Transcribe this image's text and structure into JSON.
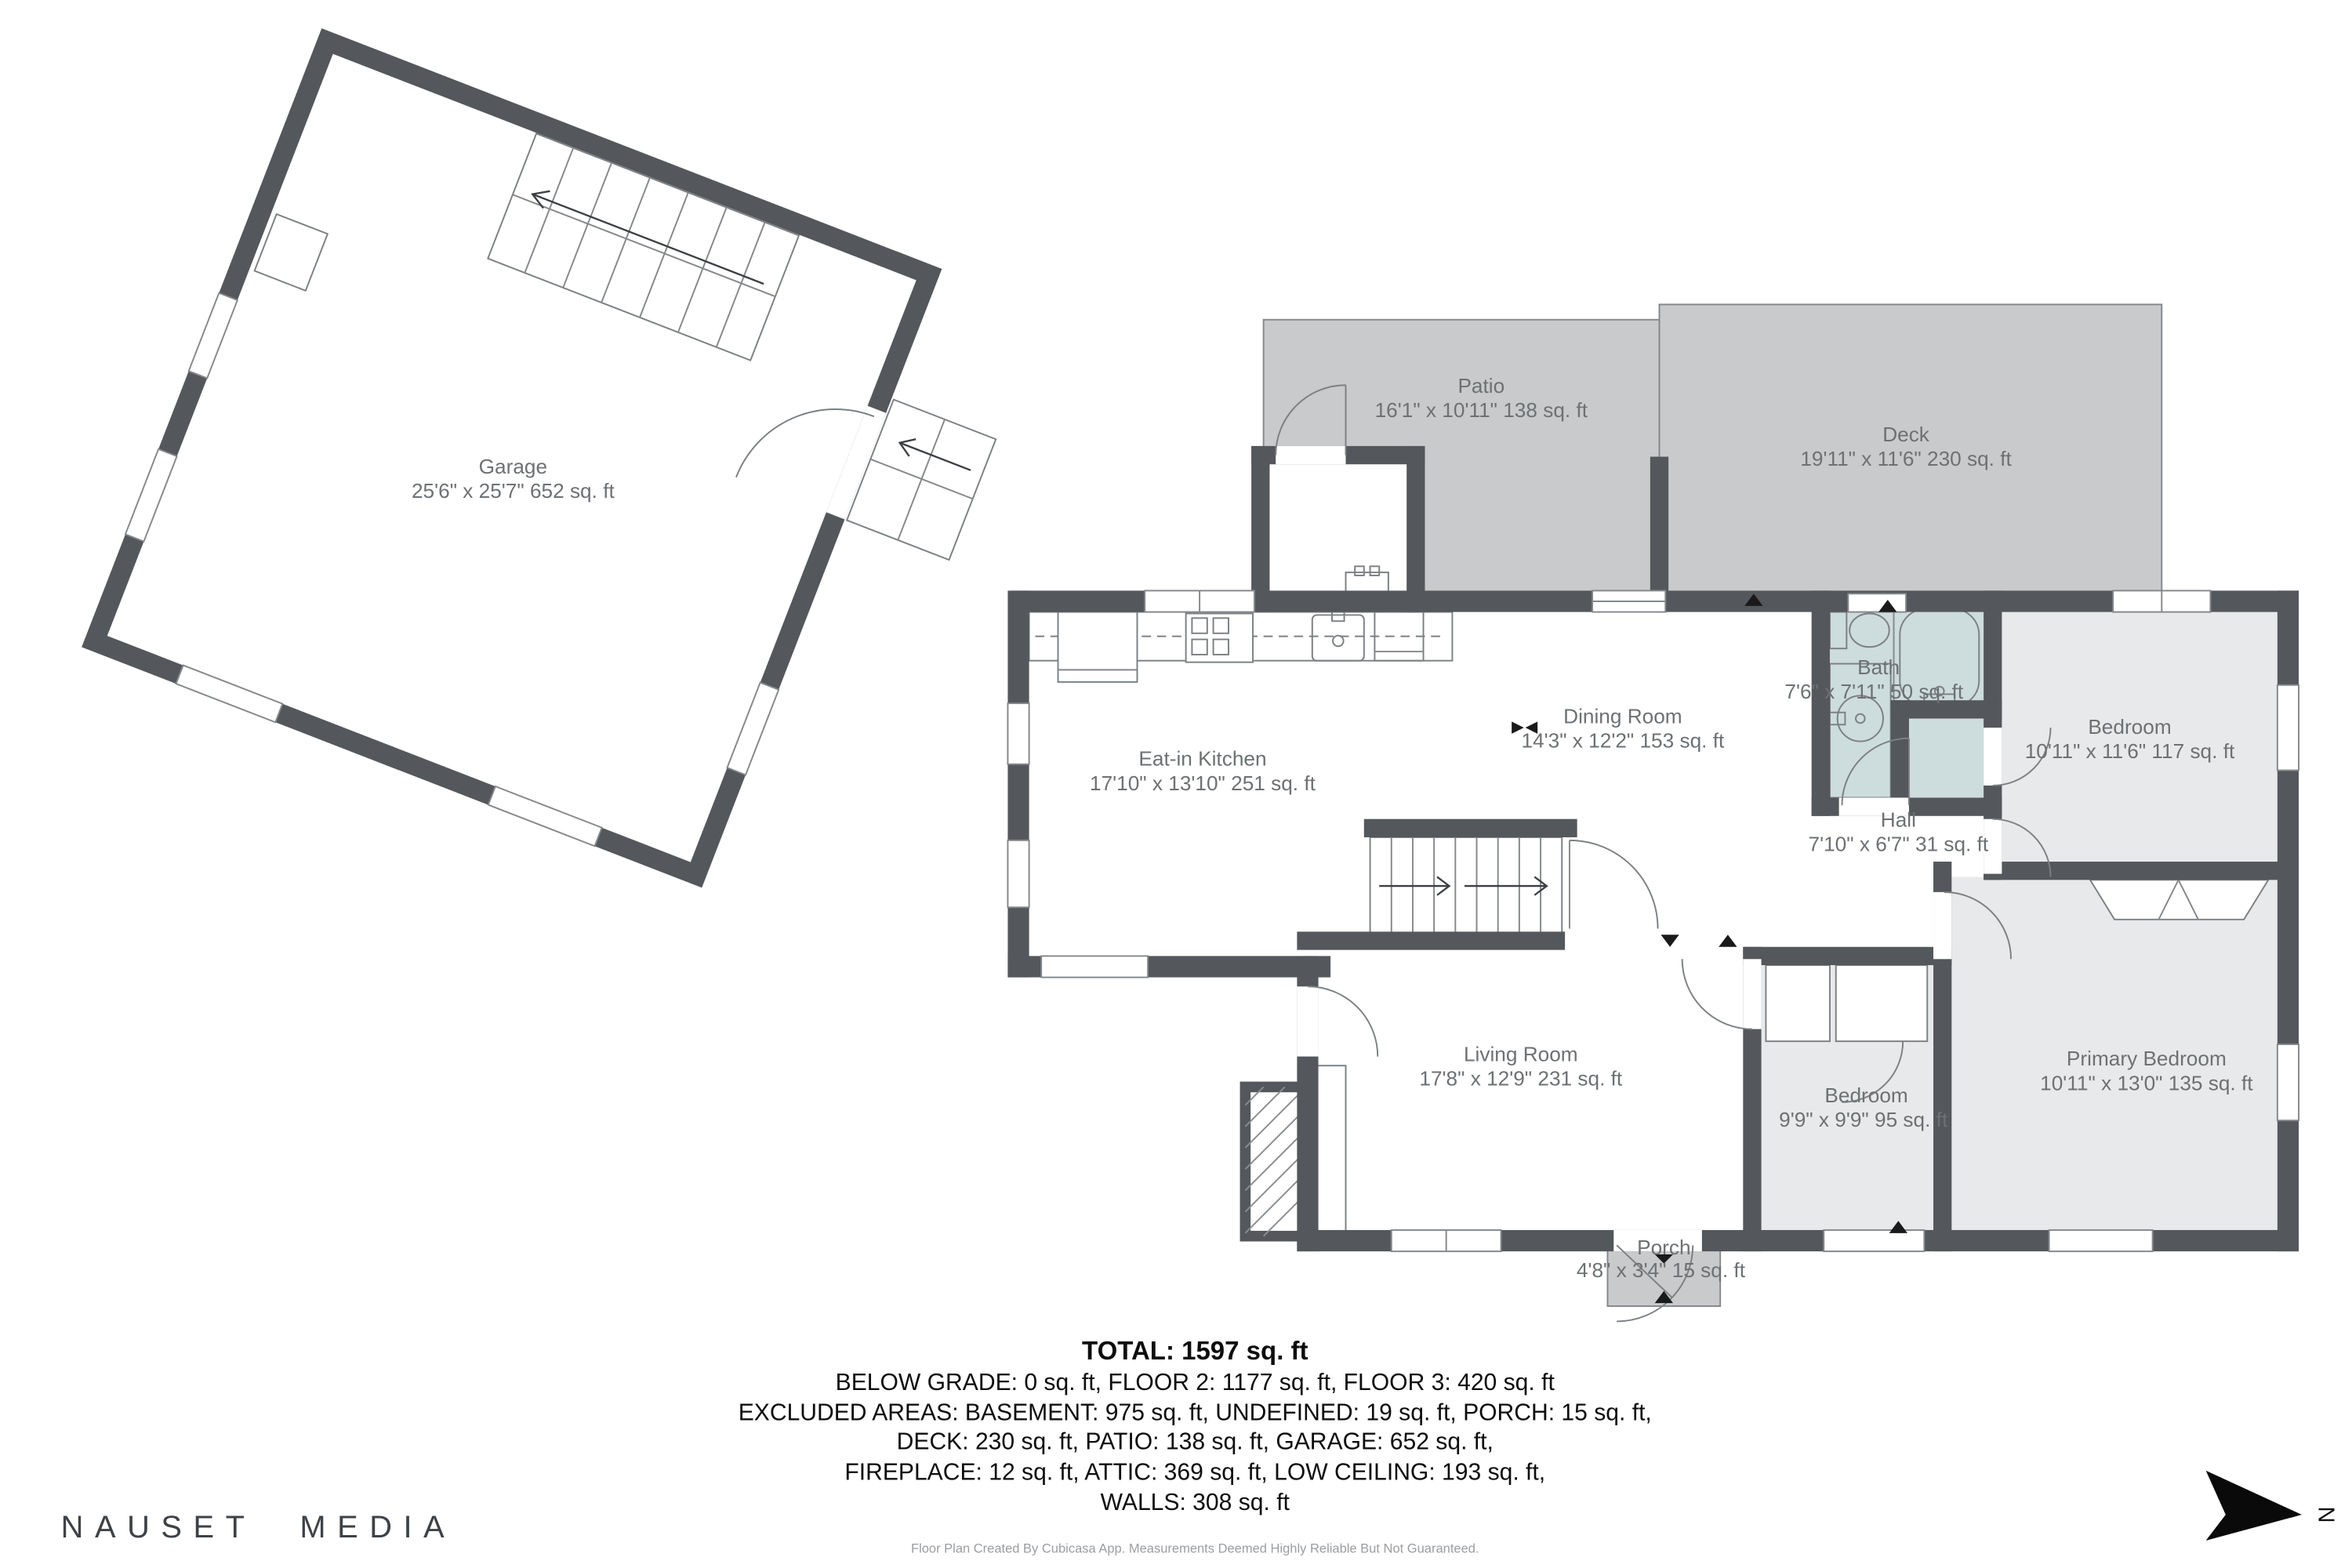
{
  "rooms": {
    "garage": {
      "name": "Garage",
      "dims": "25'6\" x 25'7\" 652 sq. ft"
    },
    "patio": {
      "name": "Patio",
      "dims": "16'1\" x 10'11\" 138 sq. ft"
    },
    "deck": {
      "name": "Deck",
      "dims": "19'11\" x 11'6\" 230 sq. ft"
    },
    "bath": {
      "name": "Bath",
      "dims": "7'6\" x 7'11\" 50 sq. ft"
    },
    "bedroom_top_right": {
      "name": "Bedroom",
      "dims": "10'11\" x 11'6\" 117 sq. ft"
    },
    "dining_room": {
      "name": "Dining Room",
      "dims": "14'3\" x 12'2\" 153 sq. ft"
    },
    "kitchen": {
      "name": "Eat-in Kitchen",
      "dims": "17'10\" x 13'10\" 251 sq. ft"
    },
    "hall": {
      "name": "Hall",
      "dims": "7'10\" x 6'7\" 31 sq. ft"
    },
    "living_room": {
      "name": "Living Room",
      "dims": "17'8\" x 12'9\" 231 sq. ft"
    },
    "bedroom_bottom": {
      "name": "Bedroom",
      "dims": "9'9\" x 9'9\" 95 sq. ft"
    },
    "primary_bedroom": {
      "name": "Primary Bedroom",
      "dims": "10'11\" x 13'0\" 135 sq. ft"
    },
    "porch": {
      "name": "Porch",
      "dims": "4'8\" x 3'4\" 15 sq. ft"
    }
  },
  "summary": {
    "total": "TOTAL: 1597 sq. ft",
    "line1": "BELOW GRADE: 0 sq. ft, FLOOR 2: 1177 sq. ft, FLOOR 3: 420 sq. ft",
    "line2": "EXCLUDED AREAS: BASEMENT: 975 sq. ft, UNDEFINED: 19 sq. ft, PORCH: 15 sq. ft,",
    "line3": "DECK: 230 sq. ft, PATIO: 138 sq. ft, GARAGE: 652 sq. ft,",
    "line4": "FIREPLACE: 12 sq. ft, ATTIC: 369 sq. ft, LOW CEILING: 193 sq. ft,",
    "line5": "WALLS: 308 sq. ft"
  },
  "branding": {
    "company": "NAUSET MEDIA",
    "disclaimer": "Floor Plan Created By Cubicasa App. Measurements Deemed Highly Reliable But Not Guaranteed."
  },
  "compass": {
    "label": "N"
  },
  "colors": {
    "wall": "#54575b",
    "outdoor_fill": "#c9cacb",
    "room_fill": "#e8e9ea",
    "bath_fill": "#cddcdd",
    "fixture_line": "#7c8083",
    "label_text": "#6d7174",
    "summary_text": "#0d0d0d",
    "logo_text": "#3e4247",
    "disclaimer_text": "#9b9ea1"
  }
}
